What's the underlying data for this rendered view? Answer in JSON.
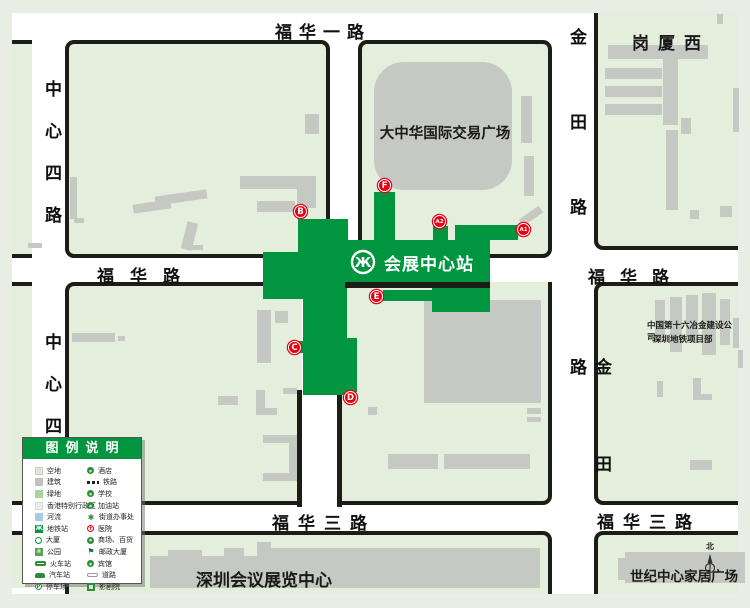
{
  "map": {
    "station": {
      "name": "会展中心站"
    },
    "exits": {
      "a1": "A1",
      "a2": "A2",
      "b": "B",
      "c": "C",
      "d": "D",
      "e": "E",
      "f": "F"
    },
    "streets": {
      "fuhua_yi_lu": "福华一路",
      "fuhua_lu_west": "福华路",
      "fuhua_lu_east": "福华路",
      "fuhua_san_lu_west": "福华三路",
      "fuhua_san_lu_east": "福华三路",
      "zhongxin_si_lu_north": "中心四路",
      "zhongxin_si_lu_south": "中心四",
      "jintian_lu_north": "金田路",
      "jintian_lu_south": "金田路"
    },
    "places": {
      "gangxia_west": "岗厦西",
      "plaza": "大中华国际交易广场",
      "company_line1": "中国第十六冶金建设公司",
      "company_line2": "深圳地铁项目部",
      "convention_center": "深圳会议展览中心",
      "century_home_plaza": "世纪中心家居广场",
      "north": "北"
    }
  },
  "legend": {
    "title": "图例说明",
    "left_items": [
      {
        "icon": "vacant-land",
        "label": "空地"
      },
      {
        "icon": "building",
        "label": "建筑"
      },
      {
        "icon": "green-space",
        "label": "绿地"
      },
      {
        "icon": "hk-sar",
        "label": "香港特别行政区"
      },
      {
        "icon": "river",
        "label": "河流"
      },
      {
        "icon": "metro-station",
        "label": "地铁站"
      },
      {
        "icon": "tower",
        "label": "大厦"
      },
      {
        "icon": "park",
        "label": "公园"
      },
      {
        "icon": "railway-station",
        "label": "火车站"
      },
      {
        "icon": "bus-station",
        "label": "汽车站"
      },
      {
        "icon": "parking-lot",
        "label": "停车场"
      }
    ],
    "right_items": [
      {
        "icon": "hotel",
        "label": "酒店"
      },
      {
        "icon": "railway",
        "label": "铁路"
      },
      {
        "icon": "school",
        "label": "学校"
      },
      {
        "icon": "gas-station",
        "label": "加油站"
      },
      {
        "icon": "subdistrict-office",
        "label": "街道办事处"
      },
      {
        "icon": "hospital",
        "label": "医院"
      },
      {
        "icon": "mall",
        "label": "商场、百货"
      },
      {
        "icon": "post-building",
        "label": "邮政大厦"
      },
      {
        "icon": "guesthouse",
        "label": "宾馆"
      },
      {
        "icon": "road",
        "label": "道路"
      },
      {
        "icon": "cinema",
        "label": "影剧院"
      }
    ]
  },
  "colors": {
    "station_green": "#009640",
    "exit_red": "#e60012",
    "block_green": "#e4eedd",
    "building_gray": "#c5c8c3",
    "curb_black": "#1d1d17"
  }
}
